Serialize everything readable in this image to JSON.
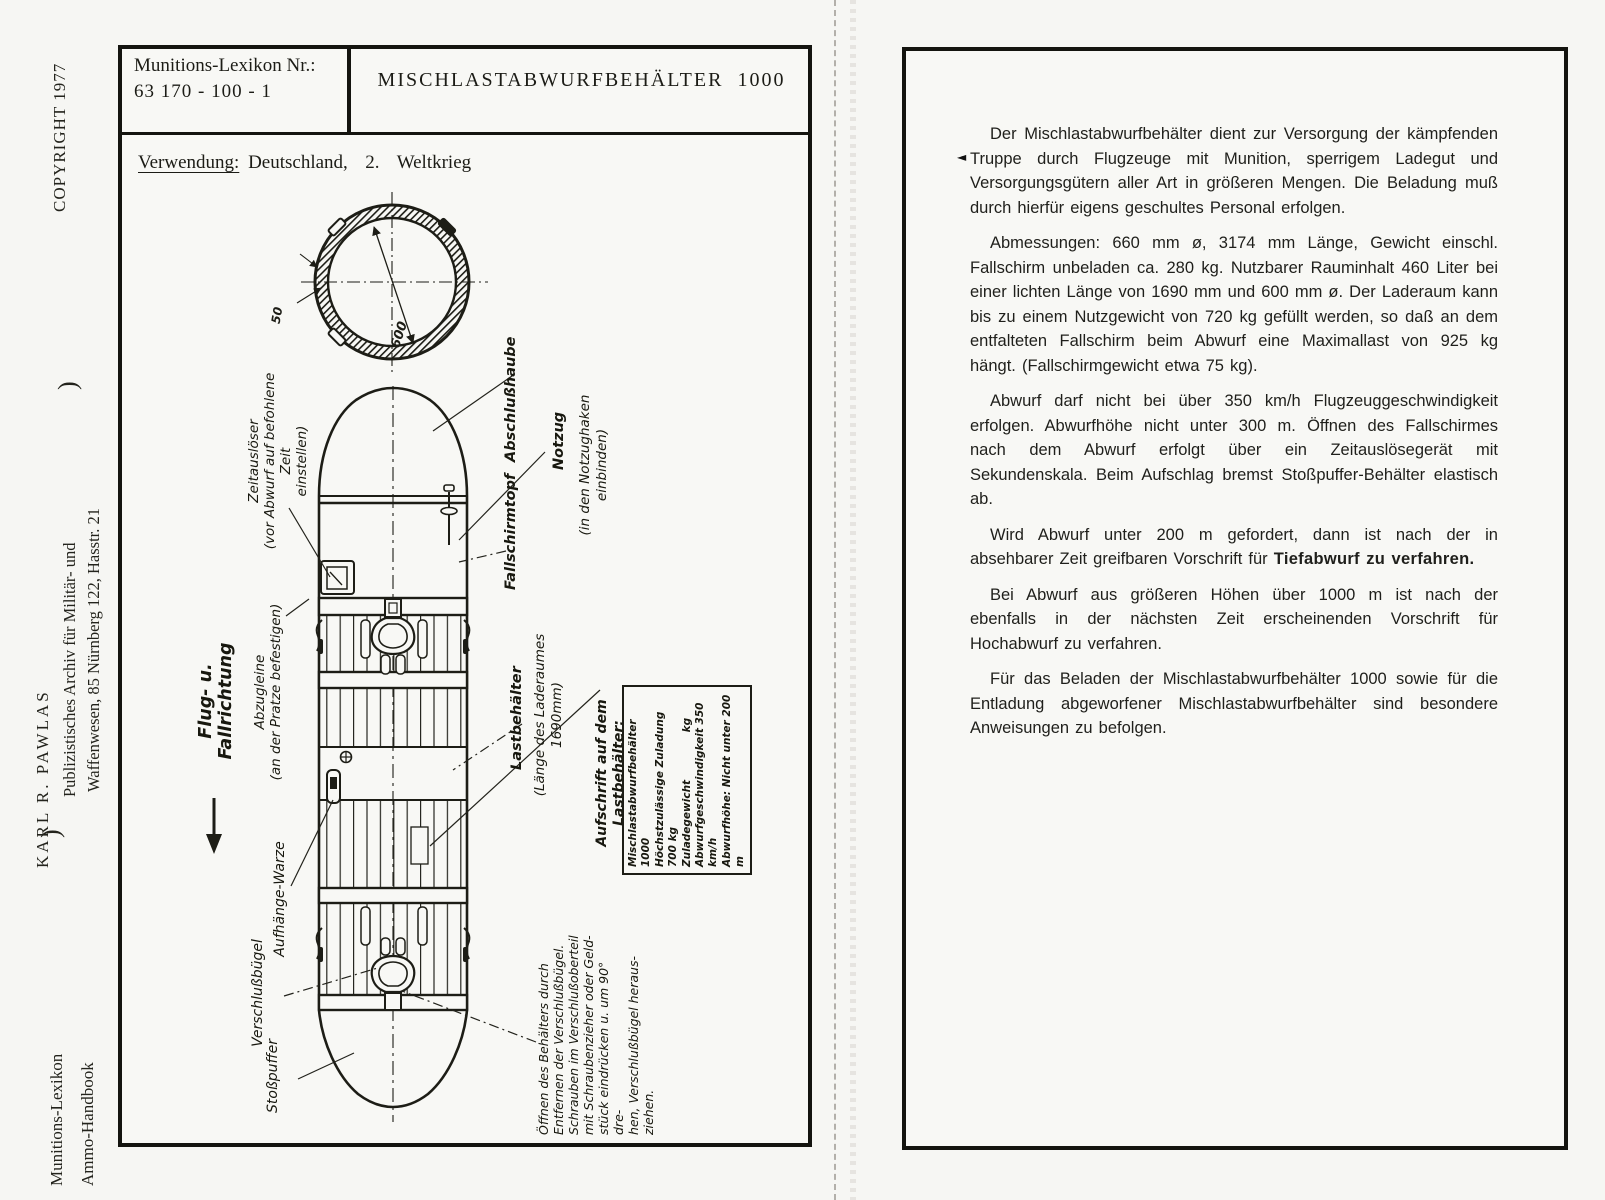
{
  "sidebar": {
    "copyright": "COPYRIGHT  1977",
    "bracket_top": ")",
    "publisher_line1": "KARL  R.  PAWLAS",
    "publisher_line2": "Publizistisches Archiv für Militär- und",
    "publisher_line3": "Waffenwesen, 85 Nürnberg 122, Hasstr. 21",
    "bracket_bottom": ")",
    "series_line1": "Munitions-Lexikon",
    "series_line2": "Ammo-Handbook"
  },
  "left_page": {
    "index_label": "Munitions-Lexikon Nr.:",
    "index_number": "63 170 - 100 - 1",
    "title": "MISCHLASTABWURFBEHÄLTER  1000",
    "usage_label": "Verwendung:",
    "usage_value": "Deutschland,  2.  Weltkrieg",
    "diagram": {
      "dim_diameter": "600",
      "dim_wall": "50",
      "direction_label": "Flug- u. Fallrichtung",
      "labels": {
        "zeitausloeser": "Zeitauslöser\n(vor Abwurf auf befohlene Zeit\neinstellen)",
        "abschlusshaube": "Abschlußhaube",
        "notzug": "Notzug",
        "notzug_note": "(in den Notzughaken einbinden)",
        "fallschirmtopf": "Fallschirmtopf",
        "abzugleine": "Abzugleine\n(an der Pratze befestigen)",
        "lastbehaelter": "Lastbehälter",
        "lastbehaelter_note": "(Länge des Laderaumes 1690mm)",
        "aufhaenge_warze": "Aufhänge-Warze",
        "verschlussbuegel": "Verschlußbügel",
        "stosspuffer": "Stoßpuffer",
        "aufschrift_heading": "Aufschrift auf dem Lastbehälter:",
        "plate_lines": "Mischlastabwurfbehälter 1000\nHöchstzulässige Zuladung 700 kg\nZuladegewicht             kg\nAbwurfgeschwindigkeit 350 km/h\nAbwurfhöhe: Nicht unter 200 m",
        "oeffnen_note": "Öffnen des Behälters durch\nEntfernen der Verschlußbügel.\nSchrauben im Verschlußoberteil\nmit Schraubenzieher oder Geld-\nstück eindrücken u. um 90° dre-\nhen, Verschlußbügel heraus-\nziehen."
      }
    }
  },
  "right_page": {
    "margin_mark": "◄",
    "paragraphs": {
      "p1": "Der Mischlastabwurfbehälter dient zur Versorgung der kämpfenden Truppe durch Flugzeuge mit Munition, sperrigem Ladegut und Versorgungsgütern aller Art in größeren Mengen. Die Beladung muß durch hierfür eigens geschultes Personal erfolgen.",
      "p2": "Abmessungen: 660 mm ø, 3174 mm Länge, Gewicht einschl. Fallschirm unbeladen ca. 280 kg. Nutzbarer Rauminhalt 460 Liter bei einer lichten Länge von 1690 mm und 600 mm ø. Der Laderaum kann bis zu einem Nutzgewicht von 720 kg gefüllt werden, so daß an dem entfalteten Fallschirm beim Abwurf eine Maximallast von 925 kg hängt. (Fallschirmgewicht etwa 75 kg).",
      "p3": "Abwurf darf nicht bei über 350 km/h Flugzeuggeschwindigkeit erfolgen. Abwurfhöhe nicht unter 300 m. Öffnen des Fallschirmes nach dem Abwurf erfolgt über ein Zeitauslösegerät mit Sekundenskala. Beim Aufschlag bremst Stoßpuffer-Behälter elastisch ab.",
      "p4_normal": "Wird Abwurf unter 200 m gefordert, dann ist nach der in absehbarer Zeit greifbaren Vorschrift für ",
      "p4_bold": "Tiefabwurf zu verfahren.",
      "p5": "Bei Abwurf aus größeren Höhen über 1000 m ist nach der ebenfalls in der nächsten Zeit erscheinenden Vorschrift für Hochabwurf zu verfahren.",
      "p6": "Für das Beladen der Mischlastabwurfbehälter 1000 sowie für die Entladung abgeworfener Mischlastabwurfbehälter sind besondere Anweisungen zu befolgen."
    }
  }
}
